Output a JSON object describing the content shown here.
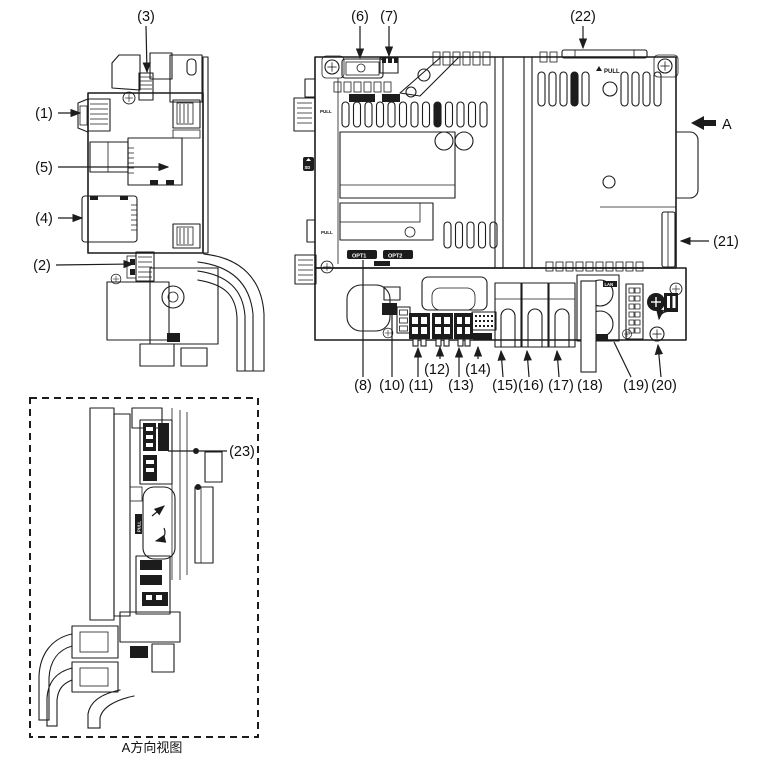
{
  "figure": {
    "type": "technical-line-diagram",
    "caption": "A方向视图",
    "view_direction_label": "A"
  },
  "callouts": {
    "n1": "(1)",
    "n2": "(2)",
    "n3": "(3)",
    "n4": "(4)",
    "n5": "(5)",
    "n6": "(6)",
    "n7": "(7)",
    "n8": "(8)",
    "n10": "(10)",
    "n11": "(11)",
    "n12": "(12)",
    "n13": "(13)",
    "n14": "(14)",
    "n15": "(15)",
    "n16": "(16)",
    "n17": "(17)",
    "n18": "(18)",
    "n19": "(19)",
    "n20": "(20)",
    "n21": "(21)",
    "n22": "(22)",
    "n23": "(23)"
  },
  "device_texts": {
    "pull": "PULL",
    "sd": "SD",
    "opt1": "OPT1",
    "opt2": "OPT2",
    "lan": "LAN"
  },
  "colors": {
    "line": "#1c1c1c",
    "background": "#ffffff"
  }
}
